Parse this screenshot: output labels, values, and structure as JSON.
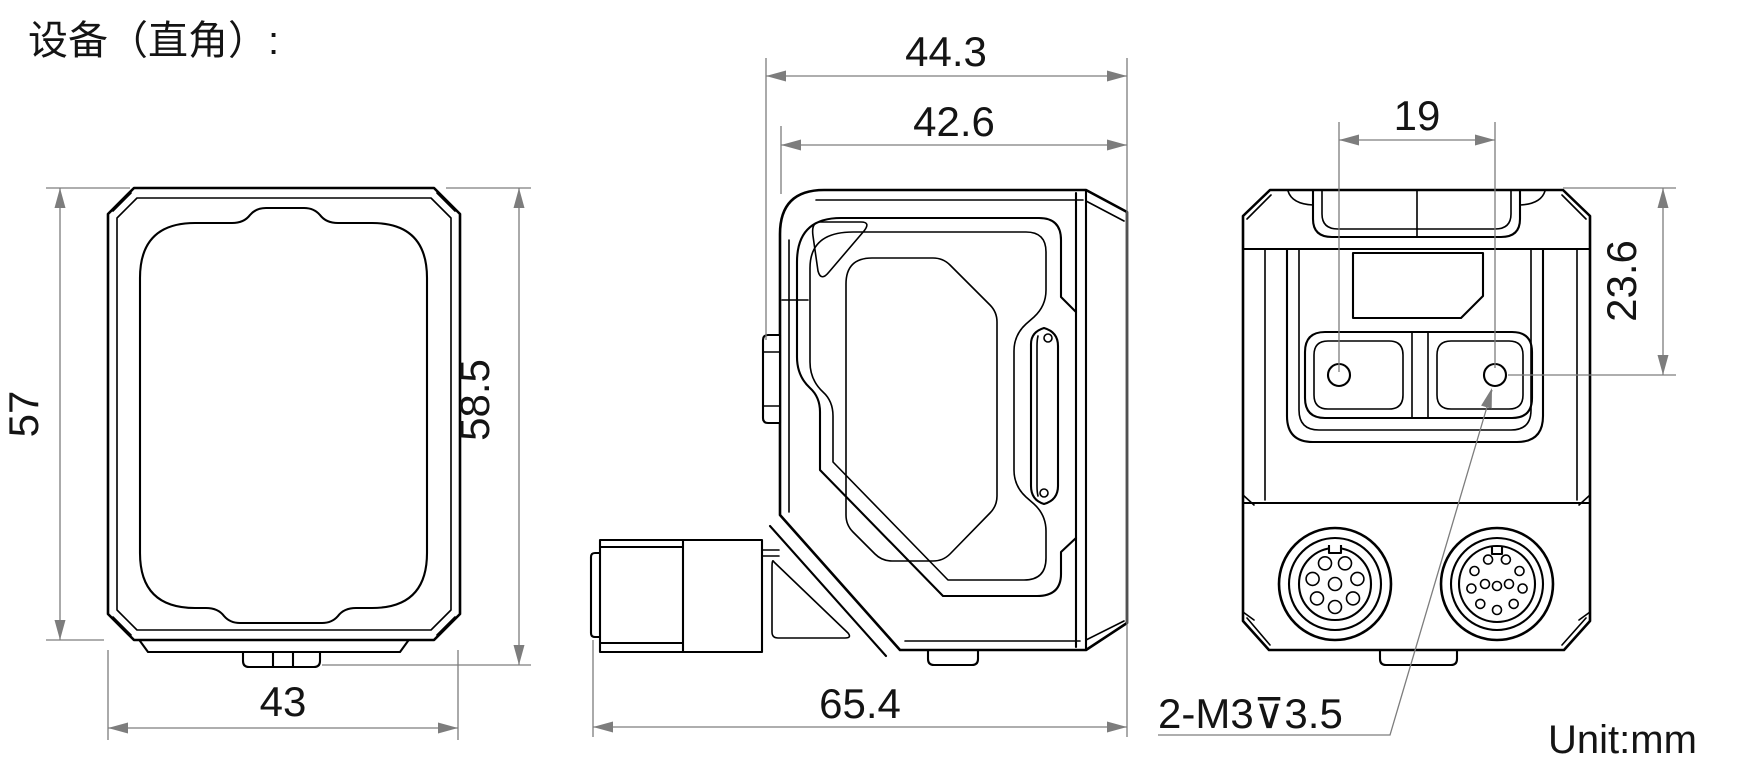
{
  "page": {
    "title": "设备（直角）:",
    "unit_label": "Unit:mm",
    "background_color": "#ffffff",
    "line_color": "#000000",
    "dimension_color": "#7d7d7d"
  },
  "views": {
    "front_view": {
      "dimensions": {
        "body_height_mm": "57",
        "total_height_mm": "58.5",
        "width_mm": "43"
      }
    },
    "side_view": {
      "dimensions": {
        "total_depth_mm": "44.3",
        "body_depth_mm": "42.6",
        "total_length_mm": "65.4"
      }
    },
    "rear_view": {
      "dimensions": {
        "mounting_hole_spacing_mm": "19",
        "mounting_hole_offset_mm": "23.6"
      },
      "mounting_thread_note": "2-M3⊽3.5",
      "connectors": {
        "left_connector_pin_count": 8,
        "right_connector_pin_count": 12
      }
    }
  }
}
